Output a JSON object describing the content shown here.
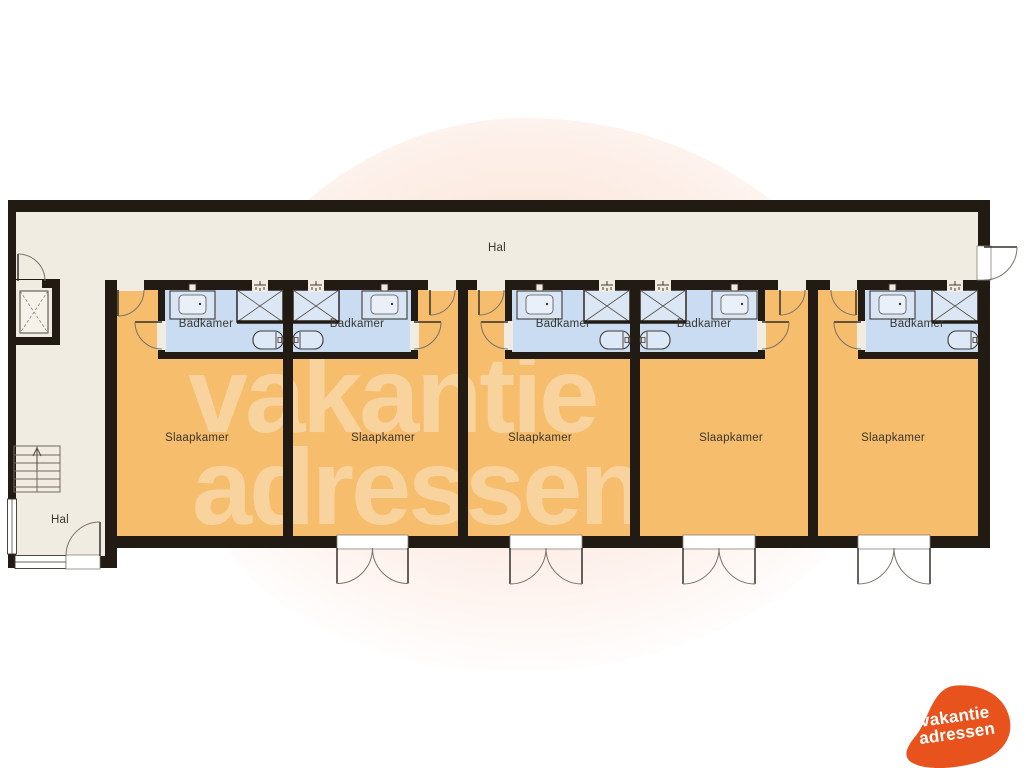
{
  "watermark": {
    "line1": "vakantie",
    "line2": "adressen"
  },
  "logo": {
    "line1": "vakantie",
    "line2": "adressen",
    "color": "#e8521c"
  },
  "floorplan": {
    "hallway_label": "Hal",
    "entry_hall_label": "Hal",
    "colors": {
      "wall": "#221b13",
      "floor": "#f1ece1",
      "bedroom": "#f6bd6d",
      "bathroom": "#c9dcf1",
      "fixture_fill": "#dce7f6",
      "watermark": "rgba(255,255,255,0.34)",
      "logo_orange": "#e8521c"
    },
    "units": [
      {
        "bedroom_label": "Slaapkamer",
        "bathroom_label": "Badkamer"
      },
      {
        "bedroom_label": "Slaapkamer",
        "bathroom_label": "Badkamer"
      },
      {
        "bedroom_label": "Slaapkamer",
        "bathroom_label": "Badkamer"
      },
      {
        "bedroom_label": "Slaapkamer",
        "bathroom_label": "Badkamer"
      },
      {
        "bedroom_label": "Slaapkamer",
        "bathroom_label": "Badkamer"
      }
    ]
  }
}
